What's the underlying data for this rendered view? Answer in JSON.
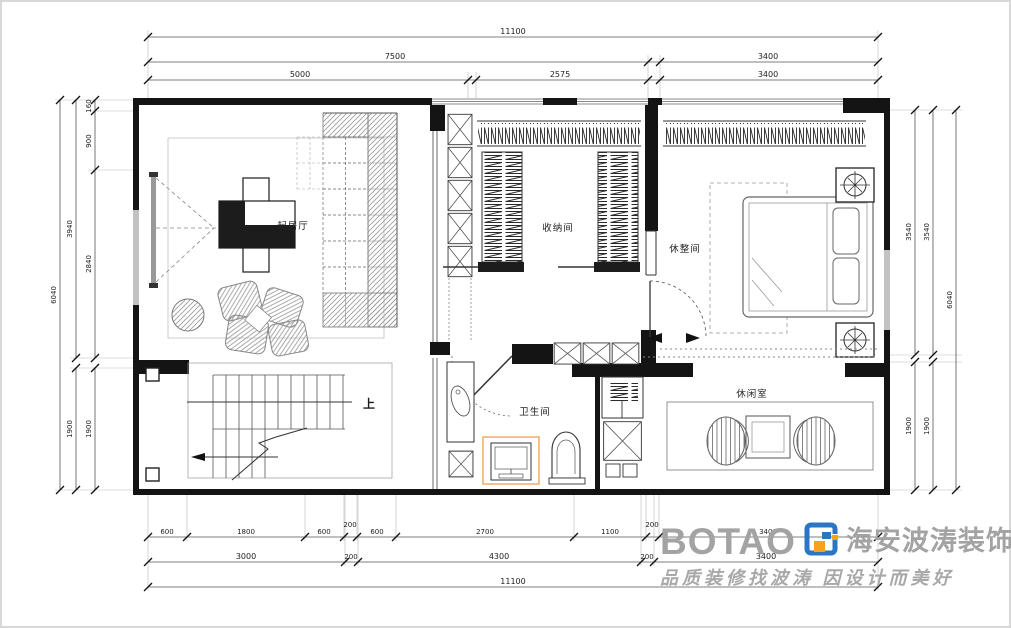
{
  "rooms": {
    "living": "起居厅",
    "storage": "收纳间",
    "rest": "休整间",
    "bath": "卫生间",
    "leisure": "休闲室",
    "stair_up": "上"
  },
  "dimensions": {
    "top": {
      "total": "11100",
      "mid": [
        "7500",
        "3400"
      ],
      "inner": [
        "5000",
        "2575",
        "3400"
      ]
    },
    "bottom": {
      "inner": [
        "600",
        "1800",
        "600",
        "200",
        "600",
        "2700",
        "1100",
        "200",
        "3400"
      ],
      "mid": [
        "3000",
        "200",
        "4300",
        "200",
        "3400"
      ],
      "total": "11100"
    },
    "left": {
      "inner": [
        "160",
        "900",
        "2840",
        "1900"
      ],
      "mid": [
        "3940",
        "1900"
      ],
      "total": "6040"
    },
    "right": {
      "col1": [
        "3540",
        "1900"
      ],
      "col2": [
        "3540",
        "1900"
      ],
      "total": "6040"
    }
  },
  "watermark": {
    "logo_text": "BOTAO",
    "brand": "海安波涛装饰",
    "slogan": "品质装修找波涛 因设计而美好"
  },
  "colors": {
    "wall": "#141414",
    "accent_orange": "#f2a45c",
    "logo_blue": "#2a76c5",
    "logo_orange": "#f6a21d",
    "watermark_gray": "#a3a3a3"
  }
}
